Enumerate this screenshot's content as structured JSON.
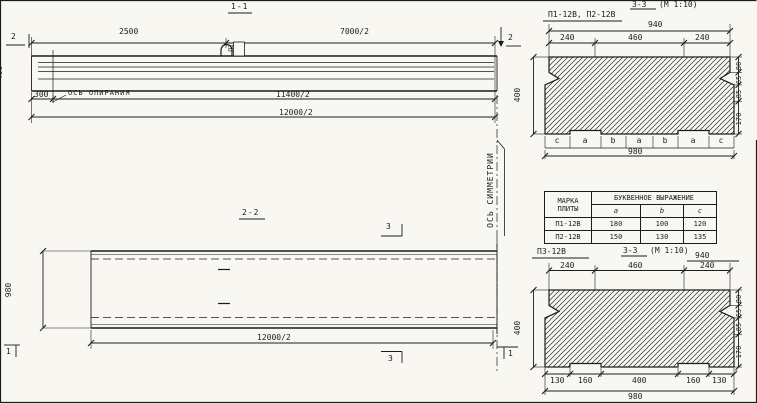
{
  "palette": {
    "paper": "#f8f7f2",
    "ink": "#1c1c1c"
  },
  "section_1_1": {
    "title": "1-1",
    "dim_top_left": "2500",
    "dim_top_right": "7000/2",
    "marker_left": "2",
    "marker_right": "2",
    "height_dim": "400",
    "dim_offset": "300",
    "bearing_axis_label": "ОСЬ ОПИРАНИЯ",
    "dim_mid": "11400/2",
    "dim_total": "12000/2",
    "loop_mark": "ПЗ"
  },
  "section_2_2": {
    "title": "2-2",
    "width_dim": "980",
    "dim_total": "12000/2",
    "marker_3_top": "3",
    "marker_3_bottom": "3",
    "marker_1_left": "1",
    "marker_1_right": "1",
    "symmetry_axis_label": "ОСЬ СИММЕТРИИ"
  },
  "cross_section_top": {
    "label": "П1-12В, П2-12В",
    "title": "3-3",
    "scale": "(М 1:10)",
    "dim_940": "940",
    "dim_240_left": "240",
    "dim_460": "460",
    "dim_240_right": "240",
    "dim_400": "400",
    "right_dims": [
      "80",
      "65",
      "85",
      "170"
    ],
    "letters": [
      "c",
      "a",
      "b",
      "a",
      "b",
      "a",
      "c"
    ],
    "dim_980": "980"
  },
  "cross_section_bottom": {
    "label": "П3-12В",
    "title": "3-3",
    "scale": "(М 1:10)",
    "dim_940": "940",
    "dim_240_left": "240",
    "dim_460": "460",
    "dim_240_right": "240",
    "dim_400": "400",
    "right_dims": [
      "80",
      "65",
      "85",
      "170"
    ],
    "bottom_dims": [
      "130",
      "160",
      "400",
      "160",
      "130"
    ],
    "dim_980": "980"
  },
  "table": {
    "col_header": "МАРКА ПЛИТЫ",
    "group_header": "БУКВЕННОЕ ВЫРАЖЕНИЕ",
    "columns": [
      "a",
      "b",
      "c"
    ],
    "rows": [
      {
        "mark": "П1-12В",
        "a": "180",
        "b": "100",
        "c": "120"
      },
      {
        "mark": "П2-12В",
        "a": "150",
        "b": "130",
        "c": "135"
      }
    ]
  }
}
